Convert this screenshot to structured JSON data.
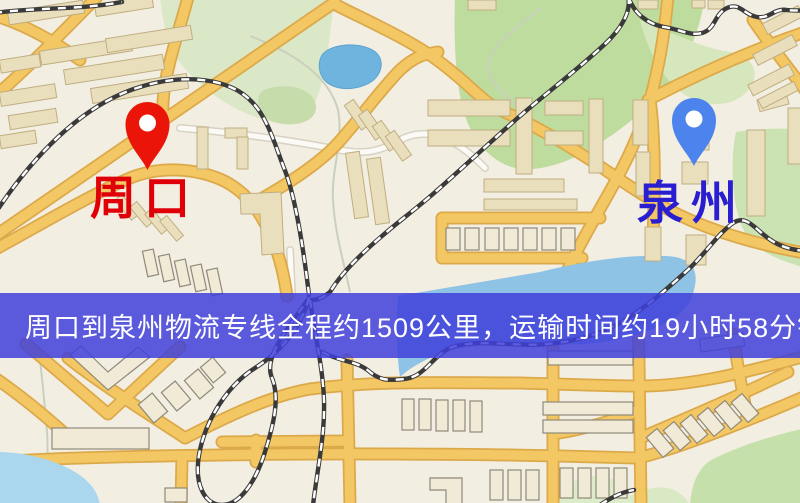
{
  "page": {
    "width": 800,
    "height": 503
  },
  "banner": {
    "text": "周口到泉州物流专线全程约1509公里，运输时间约19小时58分钟.",
    "background_rgba": "rgba(63,63,219,0.85)",
    "text_color": "#ffffff"
  },
  "markers": {
    "origin": {
      "name": "周口",
      "pin_color": "#ea1508",
      "label_color": "#e00008"
    },
    "destination": {
      "name": "泉州",
      "pin_color": "#4c83ec",
      "label_color": "#2a1fd0"
    }
  },
  "map_palette": {
    "background": "#f3eee2",
    "road": "#f3c763",
    "road_casing": "#dca94a",
    "white_road": "#fbfaf6",
    "building": "#eadfbd",
    "building_outline": "#bfae80",
    "park": "#bedc9d",
    "park_light": "#dbe8c8",
    "water": "#8ec3e6",
    "pond": "#6fb4df",
    "railway": "#3a3a3a"
  }
}
